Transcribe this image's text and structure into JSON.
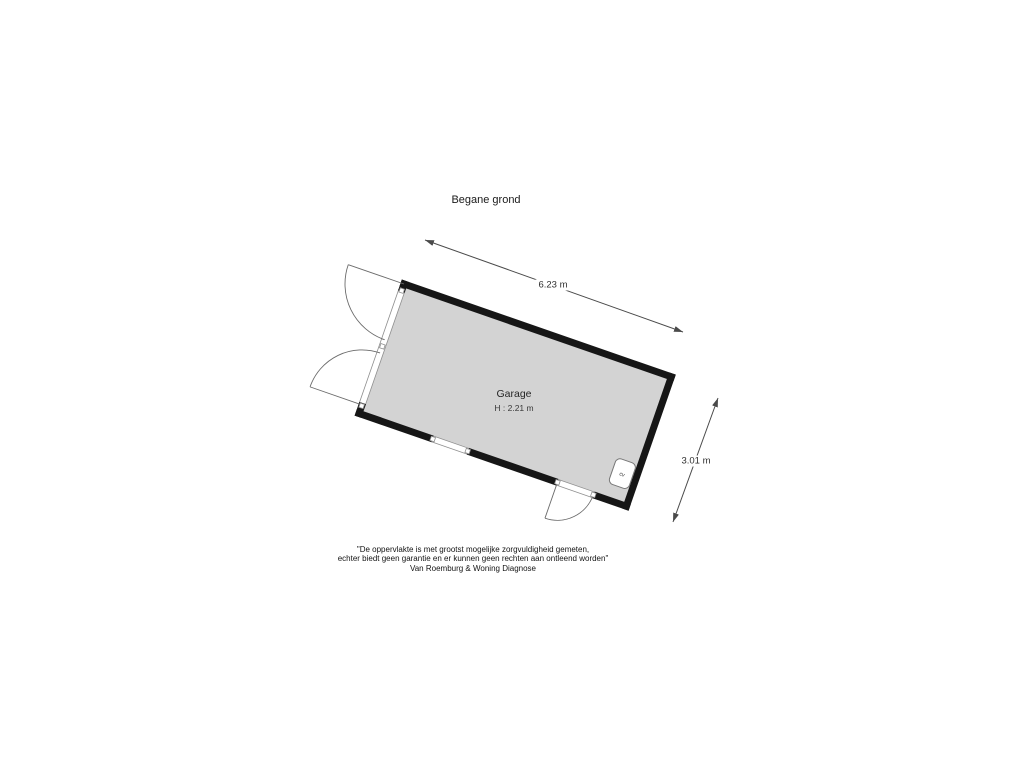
{
  "title": "Begane grond",
  "plan": {
    "room_label": "Garage",
    "room_height_label": "H : 2.21 m",
    "boiler_label": "cv",
    "dim_width_label": "6.23 m",
    "dim_depth_label": "3.01 m"
  },
  "footer": {
    "line1": "\"De oppervlakte is met grootst mogelijke zorgvuldigheid gemeten,",
    "line2": "echter biedt geen garantie en er kunnen geen rechten aan ontleend worden\"",
    "line3": "Van Roemburg & Woning Diagnose"
  },
  "colors": {
    "room_fill": "#d3d3d3",
    "wall": "#161616",
    "thin_line": "#8f8f8f",
    "dimension_line": "#4a4a4a",
    "text": "#1a1a1a"
  }
}
